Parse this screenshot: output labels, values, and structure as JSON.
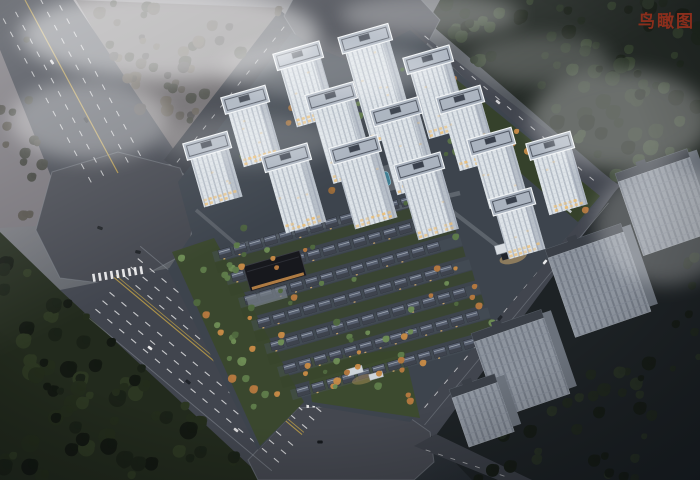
{
  "header": {
    "view_label": "鸟瞰图"
  },
  "scene": {
    "type": "architectural-aerial-rendering",
    "time_of_day": "dusk with fog",
    "site": {
      "highrise_towers": 14,
      "lowrise_house_rows": 7,
      "amenities": [
        "central pool",
        "dark clubhouse",
        "landscaped courtyards",
        "lit entrance gate"
      ],
      "entrances": 2
    },
    "surroundings": {
      "octagonal_intersections": 3,
      "gray_slab_buildings": 4,
      "wide_boulevard": "multi-lane with yellow centerline",
      "forest": "dense dark tree cover on three sides"
    }
  },
  "colors": {
    "label_red": "#8b2e1c",
    "road": "#41454e",
    "road_dark": "#3a3e46",
    "plaza": "#44474f",
    "lane_white": "#ffffff",
    "lane_yellow": "#b79a48",
    "haze_ground": "#6b686b",
    "haze_ground2": "#747177",
    "forest_tr": "#242a26",
    "forest_bl": "#222a1d",
    "forest_right": "#1d2225",
    "site_ground": "#3d444d",
    "site_green": "#3a472e",
    "green_south": "#3c4a2f",
    "green_ne": "#35412b",
    "green_bright": "#5f7c4b",
    "tree_orange": "#bb8142",
    "tower_facade": "#dde3e8",
    "tower_side": "#b9c1ca",
    "tower_roof": "#aab3bf",
    "tower_roof_dark": "#39404c",
    "tower_trim": "#f2f5f7",
    "window_warm": "#edbe72",
    "house_roof": "#586070",
    "house_roof_dark": "#3e434d",
    "house_ridge": "#aeb6c0",
    "slab_front": "#8d949e",
    "slab_side": "#6b727c",
    "slab_top": "#3a3f47",
    "pool_blue": "#3f7d92",
    "fog_white": "#ffffff"
  }
}
